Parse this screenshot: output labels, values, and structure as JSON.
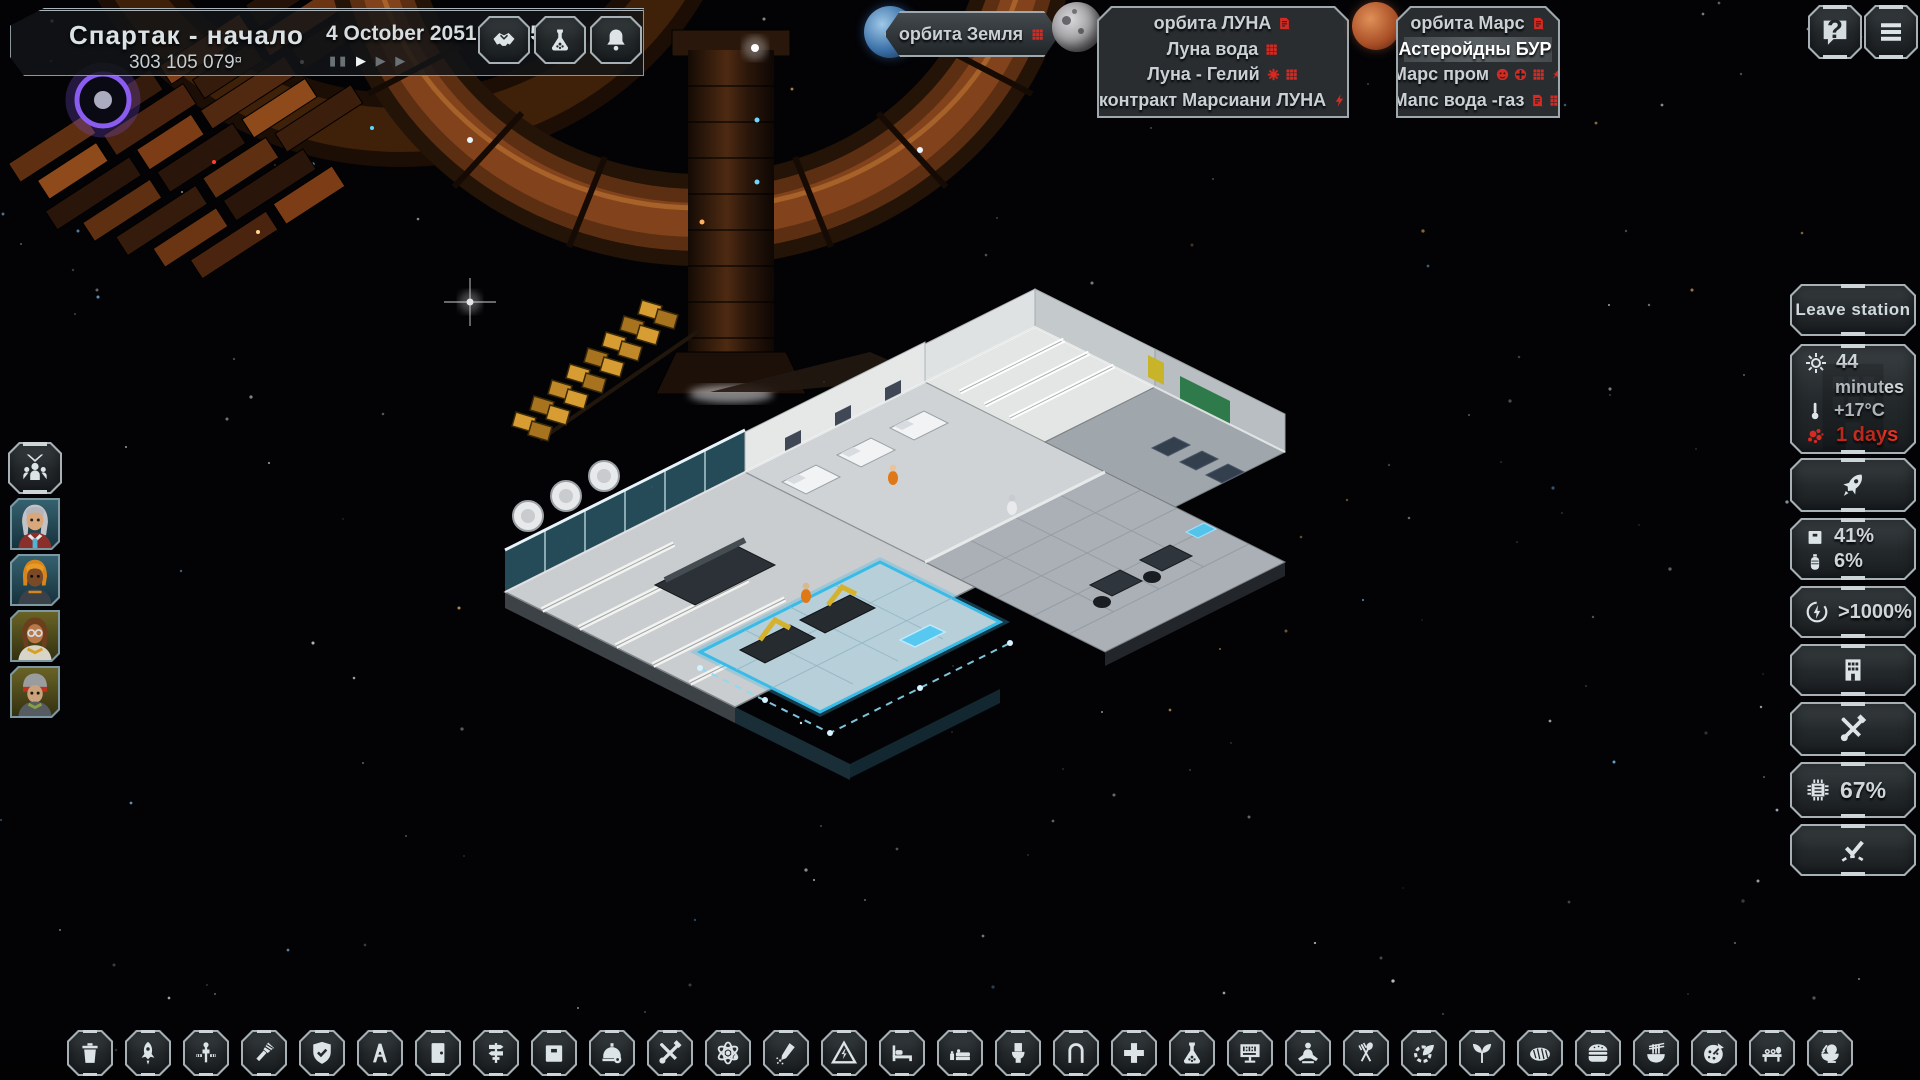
{
  "colors": {
    "accent_red": "#d42a22",
    "panel_border": "#a7b1b5",
    "text_light": "#d2d9dc",
    "blue_glow": "#49b7e8"
  },
  "header": {
    "title": "Спартак - начало",
    "money": "303 105 079",
    "currency": "¤",
    "datetime": "4 October 2051, 18:15",
    "speed": {
      "pause": "▮▮",
      "play": "▶",
      "ff": "▶",
      "fff": "▶"
    },
    "buttons": [
      {
        "icon": "handshake"
      },
      {
        "icon": "flask"
      },
      {
        "icon": "bell"
      }
    ]
  },
  "orbits": {
    "earth": {
      "label": "орбита Земля",
      "icons": [
        "grid"
      ]
    },
    "luna": {
      "rows": [
        {
          "label": "орбита ЛУНА",
          "icons": [
            "doc"
          ],
          "highlight": false
        },
        {
          "label": "Луна вода",
          "icons": [
            "grid"
          ],
          "highlight": false
        },
        {
          "label": "Луна - Гелий",
          "icons": [
            "gear",
            "grid"
          ],
          "highlight": false
        },
        {
          "label": "контракт Марсиани ЛУНА",
          "icons": [
            "bolt"
          ],
          "highlight": false
        }
      ]
    },
    "mars": {
      "rows": [
        {
          "label": "орбита Марс",
          "icons": [
            "doc"
          ],
          "highlight": false
        },
        {
          "label": "Астеройдны БУР",
          "icons": [],
          "highlight": true
        },
        {
          "label": "Марс пром",
          "icons": [
            "smiley",
            "plusc",
            "grid",
            "rocketm"
          ],
          "highlight": false
        },
        {
          "label": "Мапс вода -газ",
          "icons": [
            "doc",
            "grid"
          ],
          "highlight": false
        }
      ]
    }
  },
  "system": {
    "help": "?"
  },
  "crew": {
    "members": [
      {
        "portrait": "avatar1",
        "theme": "blue"
      },
      {
        "portrait": "avatar2",
        "theme": "blue"
      },
      {
        "portrait": "avatar3",
        "theme": "olive"
      },
      {
        "portrait": "avatar4",
        "theme": "olive"
      }
    ]
  },
  "right_panel": {
    "leave_station": "Leave station",
    "status": {
      "time_value": "44",
      "time_unit": "minutes",
      "temperature": "+17°C",
      "alert": "1 days"
    },
    "cargo": {
      "storage": "41%",
      "tank": "6%"
    },
    "power": ">1000%",
    "research": "67%"
  },
  "toolbar": {
    "items": [
      {
        "icon": "trash"
      },
      {
        "icon": "rocket"
      },
      {
        "icon": "satellite"
      },
      {
        "icon": "drill"
      },
      {
        "icon": "shield"
      },
      {
        "icon": "ramp"
      },
      {
        "icon": "door"
      },
      {
        "icon": "signpost"
      },
      {
        "icon": "crate"
      },
      {
        "icon": "helmet"
      },
      {
        "icon": "tools"
      },
      {
        "icon": "atom"
      },
      {
        "icon": "welder"
      },
      {
        "icon": "hazard"
      },
      {
        "icon": "bed"
      },
      {
        "icon": "bedroom"
      },
      {
        "icon": "toilet"
      },
      {
        "icon": "shower"
      },
      {
        "icon": "medical"
      },
      {
        "icon": "flask"
      },
      {
        "icon": "terminal"
      },
      {
        "icon": "meditation"
      },
      {
        "icon": "cutlery"
      },
      {
        "icon": "gearleaf"
      },
      {
        "icon": "plant"
      },
      {
        "icon": "bread"
      },
      {
        "icon": "burger"
      },
      {
        "icon": "noodles"
      },
      {
        "icon": "pizza"
      },
      {
        "icon": "sushi"
      },
      {
        "icon": "ricebowl"
      }
    ]
  }
}
